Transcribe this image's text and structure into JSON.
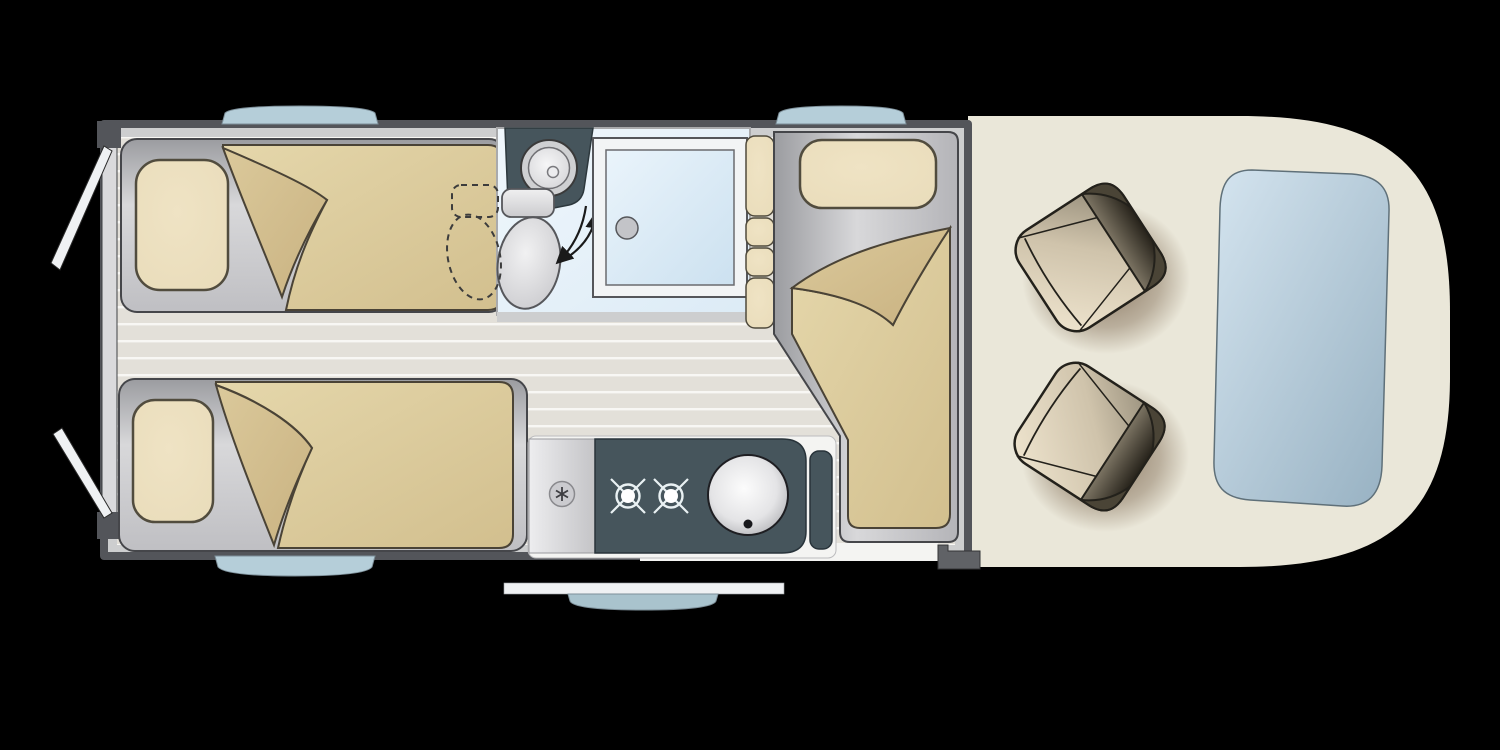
{
  "title": "Camper van floor plan (top view)",
  "colors": {
    "background": "#000000",
    "frame": "#53555a",
    "lining": "#cdcecf",
    "rear_wall": "#dadadc",
    "floor": "#e3e0d9",
    "floor_stripe": "#f8f7f4",
    "teal": "#46555c",
    "teal_edge": "#28333a",
    "bath_floor": "#dcebf6",
    "window_blue": "#b5ced9",
    "entry_blue": "#a9c3cd",
    "door_white": "#eff1f3",
    "cab_floor": "#eae7d9",
    "windshield": "#b7cedd",
    "platform_gray": "#c6c7ca",
    "pillow_tan": "#e9dcba",
    "bedding_tan": "#e5d7ab",
    "fold_tan": "#c9b281",
    "wardrobe_tan": "#c4b6a5",
    "seat_tan": "#cfc3ab",
    "seat_back": "#3a352b",
    "seat_shadow": "#4a2c10",
    "step_gray": "#606266",
    "outline_dark": "#2a2a28",
    "white": "#f4f4f2"
  },
  "floorplan": {
    "vehicle_type": "campervan",
    "view": "top-down",
    "bed_count": 3,
    "hob_burner_count": 2,
    "cab_seat_count": 2,
    "areas": [
      {
        "name": "rear-bedroom",
        "items": [
          "single-bed-top",
          "single-bed-bottom",
          "wardrobe"
        ]
      },
      {
        "name": "bathroom",
        "items": [
          "corner-washbasin",
          "swivel-toilet",
          "shower-cubicle"
        ]
      },
      {
        "name": "kitchen",
        "items": [
          "worktop",
          "two-burner-hob",
          "round-sink",
          "tall-cabinet"
        ]
      },
      {
        "name": "lounge",
        "items": [
          "longitudinal-bed",
          "backrest-cushions"
        ]
      },
      {
        "name": "cab",
        "items": [
          "swivel-seat-left",
          "swivel-seat-right",
          "windshield"
        ]
      }
    ],
    "openings": {
      "rear_doors": "two panels, open",
      "entry_door": "open, shown outside bottom wall with window",
      "windows": [
        "top-rear",
        "top-front",
        "bottom-rear"
      ]
    }
  }
}
